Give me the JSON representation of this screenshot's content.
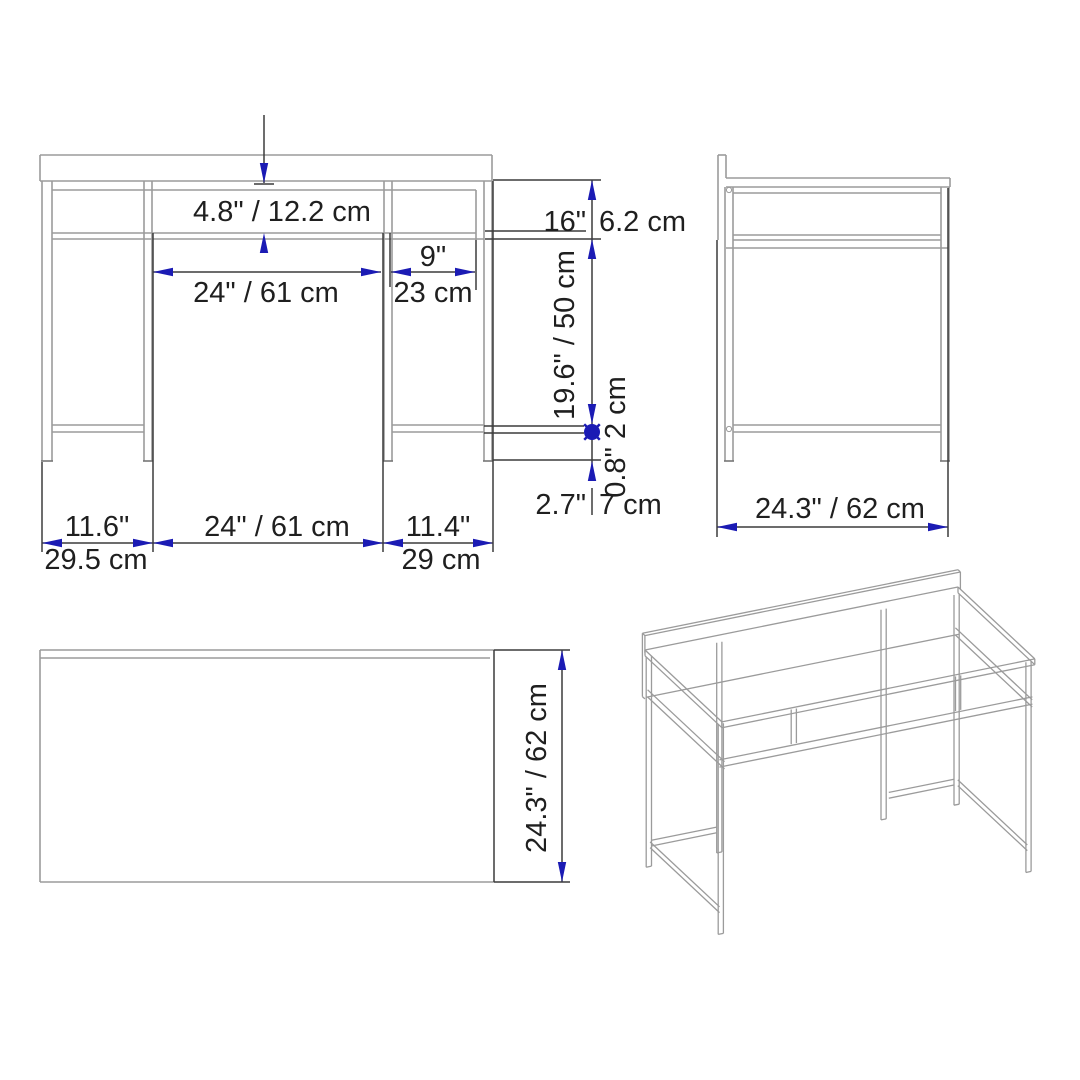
{
  "colors": {
    "background": "#ffffff",
    "object_line": "#9b9b9b",
    "outline": "#3c3c3c",
    "dimension_blue": "#1b1bb4",
    "text": "#1f1f1f"
  },
  "front_view": {
    "shelf_height": "4.8\" / 12.2 cm",
    "opening_width": "24\" / 61 cm",
    "right_opening_in": "9\"",
    "right_opening_cm": "23 cm",
    "frame_height_in": "16\"",
    "frame_height_cm": "6.2 cm",
    "knee_clearance": "19.6\" / 50 cm",
    "stretcher": "0.8\" 2 cm",
    "foot_in": "2.7\"",
    "foot_cm": "7 cm",
    "left_span_in": "11.6\"",
    "left_span_cm": "29.5 cm",
    "center_span": "24\" / 61 cm",
    "right_span_in": "11.4\"",
    "right_span_cm": "29 cm"
  },
  "side_view": {
    "depth": "24.3\" / 62 cm"
  },
  "top_view": {
    "depth": "24.3\" / 62 cm"
  }
}
